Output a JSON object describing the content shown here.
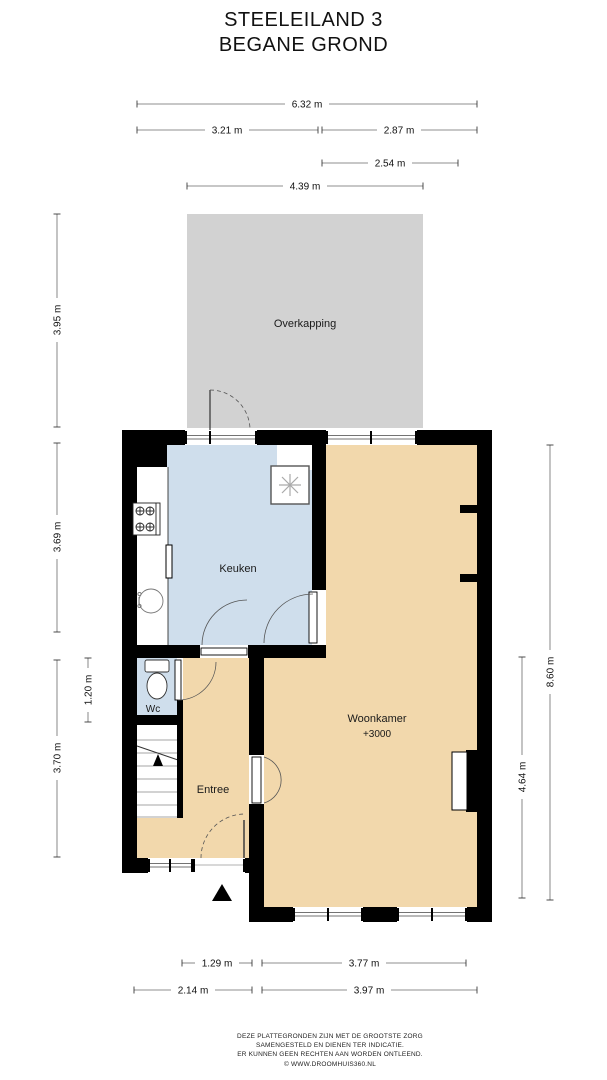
{
  "title": {
    "line1": "STEELEILAND 3",
    "line2": "BEGANE GROND"
  },
  "rooms": {
    "overkapping": {
      "label": "Overkapping",
      "color": "#d2d2d2"
    },
    "keuken": {
      "label": "Keuken",
      "color": "#cfdeec"
    },
    "wc": {
      "label": "Wc",
      "color": "#cfdeec"
    },
    "entree": {
      "label": "Entree",
      "color": "#f2d8ac"
    },
    "woonkamer": {
      "label": "Woonkamer",
      "level_note": "+3000",
      "color": "#f2d8ac"
    }
  },
  "dimensions": {
    "top": [
      {
        "label": "6.32 m"
      },
      {
        "label": "3.21 m"
      },
      {
        "label": "2.87 m"
      },
      {
        "label": "2.54 m"
      },
      {
        "label": "4.39 m"
      }
    ],
    "left": [
      {
        "label": "3.95 m"
      },
      {
        "label": "3.69 m"
      },
      {
        "label": "1.20 m"
      },
      {
        "label": "3.70 m"
      }
    ],
    "right": [
      {
        "label": "8.60 m"
      },
      {
        "label": "4.64 m"
      }
    ],
    "bottom": [
      {
        "label": "1.29 m"
      },
      {
        "label": "3.77 m"
      },
      {
        "label": "2.14 m"
      },
      {
        "label": "3.97 m"
      }
    ]
  },
  "icons": {
    "stove": "stove-icon",
    "sink": "sink-icon",
    "toilet": "toilet-icon",
    "ventilation": "ventilation-fan-icon",
    "stairs_arrow": "stairs-up-arrow-icon",
    "entrance_marker": "entrance-triangle-icon"
  },
  "wall_color": "#000000",
  "footer": {
    "line1": "DEZE PLATTEGRONDEN ZIJN MET DE GROOTSTE ZORG",
    "line2": "SAMENGESTELD EN DIENEN TER INDICATIE.",
    "line3": "ER KUNNEN GEEN RECHTEN AAN WORDEN ONTLEEND.",
    "line4": "© WWW.DROOMHUIS360.NL"
  }
}
